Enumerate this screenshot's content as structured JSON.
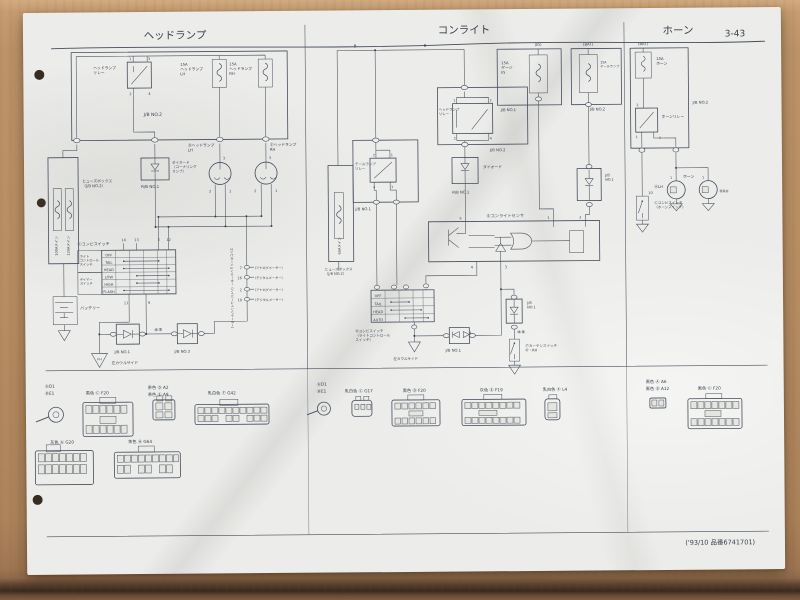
{
  "header": {
    "title_headlamp": "ヘッドランプ",
    "title_conlight": "コンライト",
    "title_horn": "ホーン",
    "page_no": "3-43"
  },
  "footer": {
    "note": "('93/10 品番6741701)"
  },
  "hl": {
    "jb2": "J/B NO.2",
    "relay": "ヘッドランプ\nリレー",
    "relay_pins": [
      "1",
      "3",
      "2",
      "4"
    ],
    "fuse_lh": "15A\nヘッドランプ\nLH",
    "fuse_rh": "15A\nヘッドランプ\nRH",
    "fusible_1": "100Aメイン",
    "fusible_2": "120Aメイン",
    "fusebox": "ヒューズボックス\n（J/B NO.2）",
    "diode": "ダイオード\n（コーナリング\nランプ）",
    "rb1": "R/B NO.1",
    "bulb_lh": "Ⓓヘッドランプ\nLH",
    "bulb_rh": "Ⓔヘッドランプ\nRH",
    "bulb_pins": [
      "3",
      "2",
      "1",
      "3",
      "2",
      "1"
    ],
    "sw_title": "Ⓒコンビスイッチ",
    "sw_grp1": "ライト\nコントロール\nスイッチ",
    "sw_grp2": "ディマー\nスイッチ",
    "rows": [
      "OFF",
      "TAIL",
      "HEAD",
      "LOW",
      "HIGH",
      "FLASH"
    ],
    "pins_top": [
      "14",
      "13",
      "3",
      "12"
    ],
    "pins_bot": [
      "11",
      "9"
    ],
    "meter": "コンビネーションメーター（ハイビームインジケーター）",
    "meter_pins": [
      {
        "n": "7",
        "label": "（アナログメーター）"
      },
      {
        "n": "16",
        "label": "（デジタルメーター）"
      },
      {
        "n": "2",
        "label": "（アナログメーター）"
      },
      {
        "n": "10",
        "label": "（デジタルメーター）"
      }
    ],
    "battery": "バッテリー",
    "gnd": "FH",
    "gnd_label": "左カウルサイド",
    "jb1": "J/B NO.1",
    "jb3": "J/B NO.3",
    "wire1": "緑-黒"
  },
  "cl": {
    "wire_b": "B",
    "tail_relay": "テールランプ\nリレー",
    "tail_jb": "J/B NO.1",
    "tr_pins": [
      "2",
      "1",
      "4",
      "3"
    ],
    "head_relay": "ヘッドランプ\nリレー",
    "head_jb": "J/B NO.2",
    "hr_pins": [
      "1",
      "3",
      "2",
      "4"
    ],
    "fusible": "60Aメイン",
    "fusebox": "ヒューズボックス\n（J/B NO.2）",
    "ig_tag": "(IG)",
    "fuse_ig": "15A\nゲージ\nIG",
    "ig_jb": "J/B NO.1",
    "bat_tag": "(BAT)",
    "fuse_tail": "15A\nテールランプ",
    "bat_jb": "J/B NO.2",
    "diode": "ダイオード",
    "rb1": "R/B NO.1",
    "jb1_small": "J/B\nNO.1",
    "sensor": "Ⓔコンライトセンサ",
    "sensor_pins": [
      "5",
      "1",
      "2",
      "4",
      "3"
    ],
    "sw_title": "Ⓓコンビスイッチ\n（ライトコントロール\nスイッチ）",
    "rows": [
      "OFF",
      "TAIL",
      "HEAD",
      "AUTO"
    ],
    "jb1_diode": "J/B NO.1",
    "gnd_label": "左カウルサイド",
    "jb1_right": "J/B\nNO.1",
    "courtesy": "Ⓕカーテシスイッチ\nFr・RH",
    "wire1": "緑-黒"
  },
  "horn": {
    "bat_tag": "(BAT)",
    "fuse": "10A\nホーン",
    "jb2": "J/B NO.2",
    "relay": "ホーンリレー",
    "relay_pins": [
      "2",
      "1",
      "3"
    ],
    "horn_label": "ホーン",
    "lh": "ⒶLH",
    "rh": "ⒷRH",
    "horn_pins": [
      "1",
      "1"
    ],
    "sw": "Ⓒコンビスイッチ\n（ホーンスイッチ）",
    "sw_pin": "10"
  },
  "conn": {
    "left": {
      "r1": "ⒶD1",
      "r2": "ⒷE1",
      "c1": "黒色 Ⓒ F20",
      "c2": "茶色 Ⓓ A2",
      "c3": "茶色 Ⓔ A9",
      "c4": "乳白色 Ⓕ G42",
      "c5": "灰色 Ⓖ G20",
      "c6": "茶色 Ⓗ G64"
    },
    "mid": {
      "r1": "ⒶD1",
      "r2": "ⒷE1",
      "c1": "乳白色 Ⓒ G17",
      "c2": "黒色 Ⓓ F20",
      "c3": "灰色 Ⓔ F19",
      "c4": "乳白色 Ⓕ L4"
    },
    "right": {
      "r1": "黒色 Ⓐ A6",
      "r2": "黒色 Ⓑ A12",
      "c1": "黒色 Ⓒ F20"
    }
  }
}
